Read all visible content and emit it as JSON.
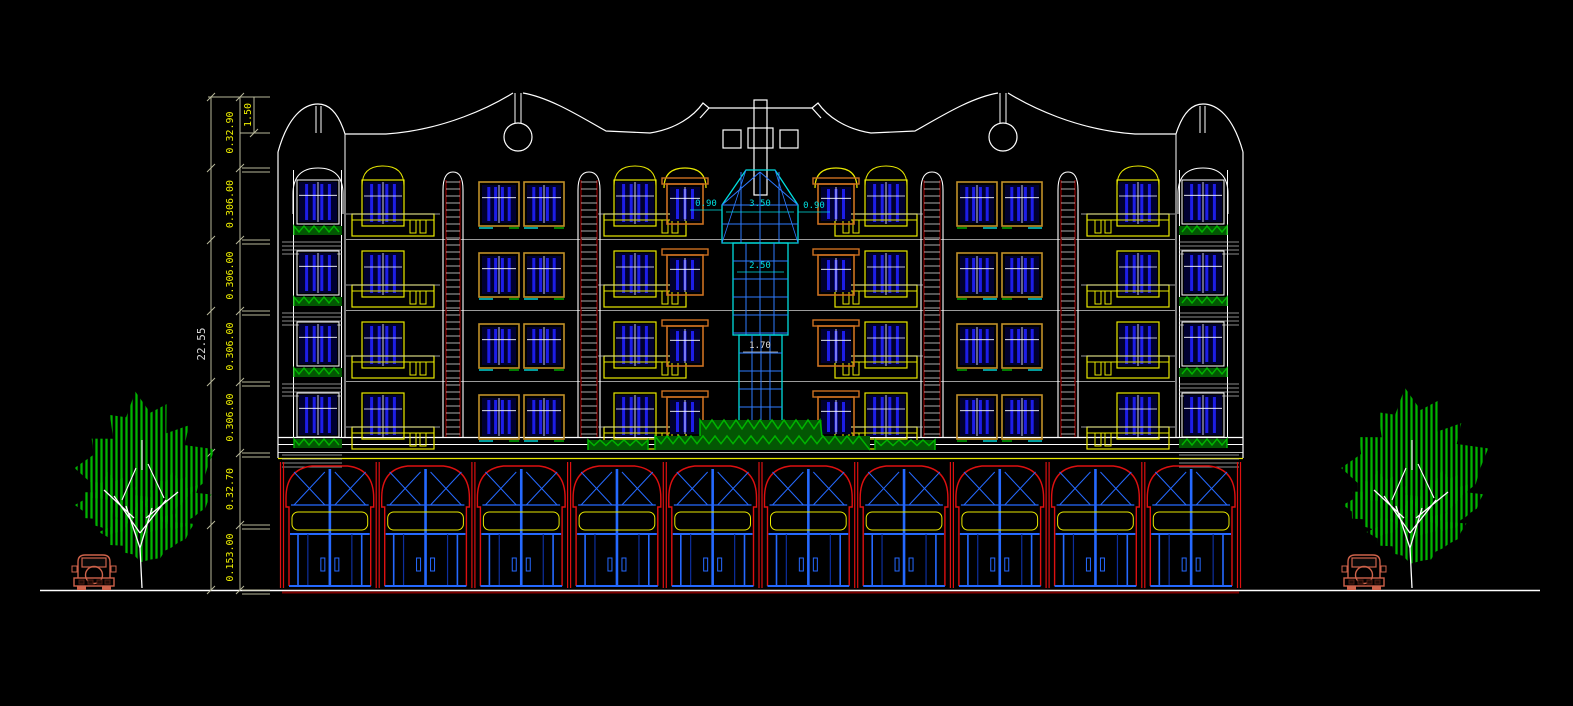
{
  "document": {
    "type": "cad-elevation-drawing",
    "description": "Architectural front elevation of a five-storey building with ground-floor shops, central glass curtain-wall tower, corner window towers, trees and cars",
    "background": "#000000"
  },
  "dimension_chain": {
    "total_label": "22.55",
    "parapet_label": "1.50",
    "segment_labels": [
      "0.32.90",
      "0.306.00",
      "0.306.00",
      "0.306.00",
      "0.306.00",
      "0.32.70",
      "0.153.00"
    ]
  },
  "tower_annotations": {
    "left_width": "0.90",
    "top_width": "3.50",
    "right_width": "0.90",
    "mid_width": "2.50",
    "lower_width": "1.70"
  },
  "scene": {
    "upper_floors": 4,
    "shop_bays": 10,
    "trees": 2,
    "cars": 2
  },
  "colors": {
    "outline": "#e8e8e8",
    "dim_text": "#f0f000",
    "dim_line": "#b8b89a",
    "total_text": "#d8d8d8",
    "glass_bar": "#1d1de8",
    "glass_dark": "#000030",
    "mullion_blue": "#2e7bff",
    "shop_mullion": "#2569ff",
    "frame_yellow": "#e8e800",
    "frame_tan": "#c09028",
    "frame_orange": "#cc7020",
    "cyan": "#00dede",
    "green": "#00b400",
    "green_dark": "#035703",
    "shop_red": "#dd1010",
    "dark_red": "#7d0000",
    "car_color": "#cd624a",
    "white": "#ffffff"
  }
}
